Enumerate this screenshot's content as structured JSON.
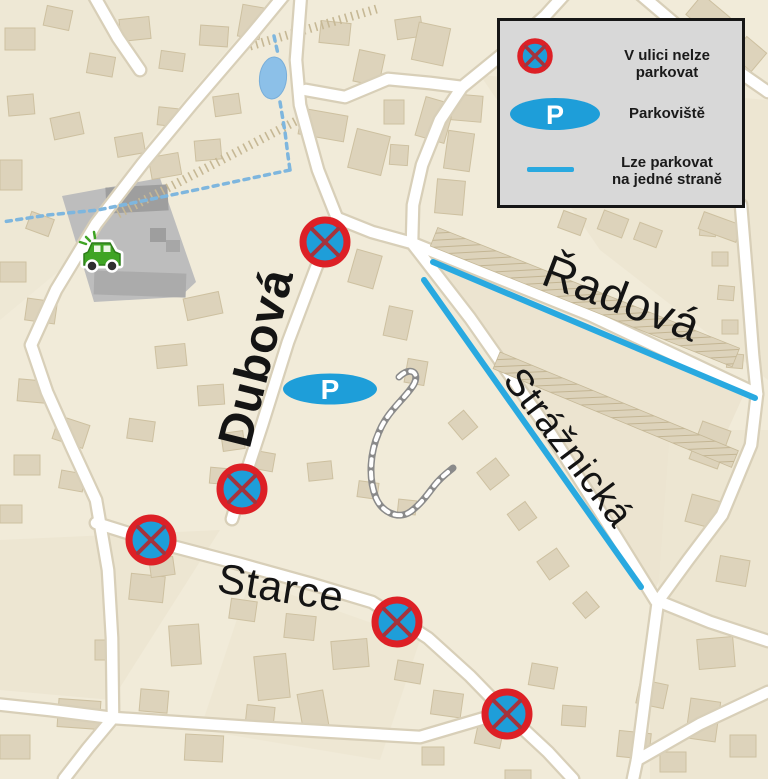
{
  "map": {
    "street_labels": [
      {
        "id": "dubova",
        "name": "Dubová",
        "x": 257,
        "y": 358,
        "rotation": -76,
        "font_size": 48,
        "bold": true
      },
      {
        "id": "radova",
        "name": "Řadová",
        "x": 622,
        "y": 298,
        "rotation": 21,
        "font_size": 46,
        "bold": false
      },
      {
        "id": "straznicka",
        "name": "Strážnická",
        "x": 568,
        "y": 448,
        "rotation": 53,
        "font_size": 38,
        "bold": false
      },
      {
        "id": "starce",
        "name": "Starce",
        "x": 281,
        "y": 588,
        "rotation": 9,
        "font_size": 42,
        "bold": false
      }
    ],
    "no_parking_markers": [
      {
        "x": 325,
        "y": 242
      },
      {
        "x": 242,
        "y": 489
      },
      {
        "x": 151,
        "y": 540
      },
      {
        "x": 397,
        "y": 622
      },
      {
        "x": 507,
        "y": 714
      }
    ],
    "parking_marker": {
      "x": 330,
      "y": 389,
      "label": "P"
    },
    "one_side_lines": [
      {
        "x1": 433,
        "y1": 262,
        "x2": 755,
        "y2": 398
      },
      {
        "x1": 424,
        "y1": 280,
        "x2": 641,
        "y2": 587
      }
    ],
    "colors": {
      "no_parking_fill": "#1e9ed9",
      "no_parking_ring": "#dd2026",
      "no_parking_cross": "#a5333c",
      "parking_fill": "#1e9ed9",
      "line_blue": "#29a9e0"
    }
  },
  "legend": {
    "no_parking_label": "V ulici nelze parkovat",
    "parking_label": "Parkoviště",
    "parking_symbol": "P",
    "line_label_line1": "Lze parkovat",
    "line_label_line2": "na jedné straně"
  }
}
